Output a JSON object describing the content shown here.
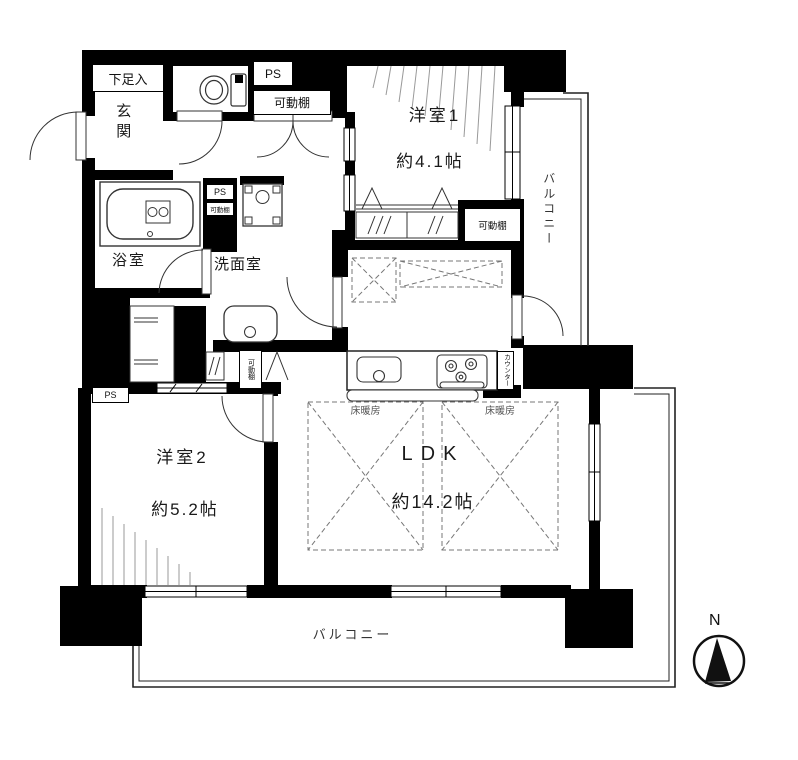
{
  "plan": {
    "entrance": {
      "label": "玄関",
      "shoe_box_label": "下足入"
    },
    "bathroom": {
      "label": "浴室"
    },
    "washroom": {
      "label": "洗面室"
    },
    "room1": {
      "label": "洋室1",
      "size": "約4.1帖"
    },
    "room2": {
      "label": "洋室2",
      "size": "約5.2帖"
    },
    "ldk": {
      "label": "LDK",
      "size": "約14.2帖"
    },
    "kitchen": {
      "counter_label": "カウンター"
    },
    "balcony_right": {
      "label": "バルコニー"
    },
    "balcony_bottom": {
      "label": "バルコニー"
    },
    "tags": {
      "ps": "PS",
      "movable_shelf": "可動棚",
      "floor_heating": "床暖房"
    },
    "compass": {
      "north_label": "N"
    },
    "colors": {
      "wall": "#000000",
      "line": "#333333",
      "hatch": "#999999",
      "dashed": "#777777"
    }
  }
}
